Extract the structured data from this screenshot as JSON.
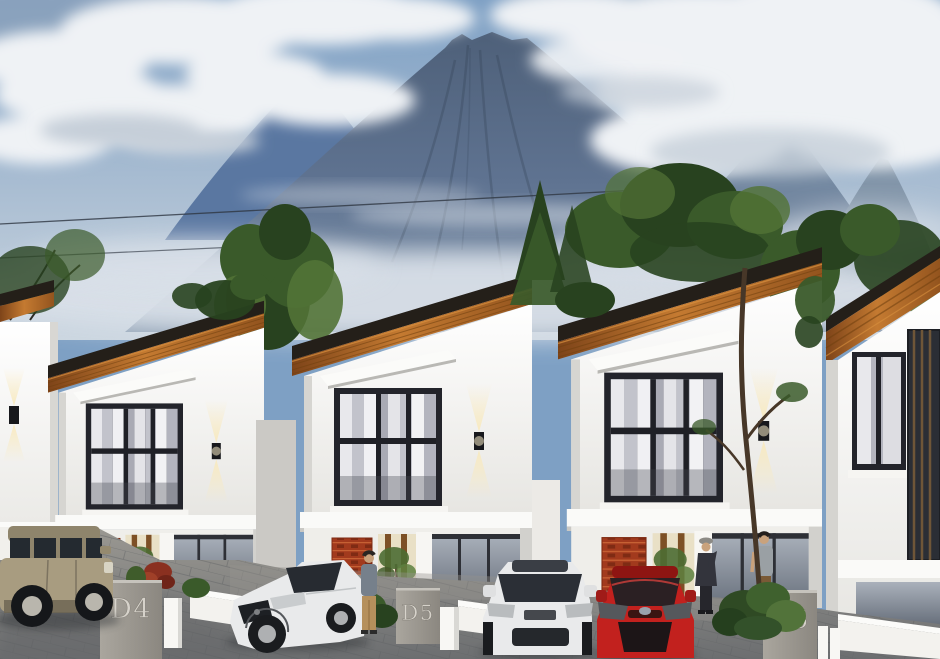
{
  "pillars": [
    {
      "label": "D4"
    },
    {
      "label": "D5"
    },
    {
      "label": "D6"
    }
  ],
  "palette": {
    "sky_top": "#7ea0c4",
    "sky_horizon": "#cbd6e0",
    "cloud_white": "#eff2f5",
    "cloud_shadow": "#c6cfd9",
    "mountain_top": "#4e6079",
    "mountain_base": "#8195ab",
    "mountain_far_left": "#5a77a1",
    "mountain_ridge_right": "#71859e",
    "roof_wood_mid": "#c47a31",
    "roof_fascia": "#241f19",
    "wall_white": "#ffffff",
    "window_frame": "#23242b",
    "brick": "#a23a1d",
    "sconce_glow": "#f9e9bb",
    "paving_light": "#9a9892",
    "paving_dark": "#6c6e70",
    "pillar_light": "#aaa69e",
    "pillar_dark": "#8b8780",
    "label_color": "#dcd8d0",
    "suv_tan": "#a89c80",
    "car_white": "#e9eaeb",
    "car_red": "#c2211e",
    "tree_dark": "#28421f",
    "tree_mid": "#3a5a2a",
    "tree_light": "#527336",
    "trunk": "#473728"
  }
}
